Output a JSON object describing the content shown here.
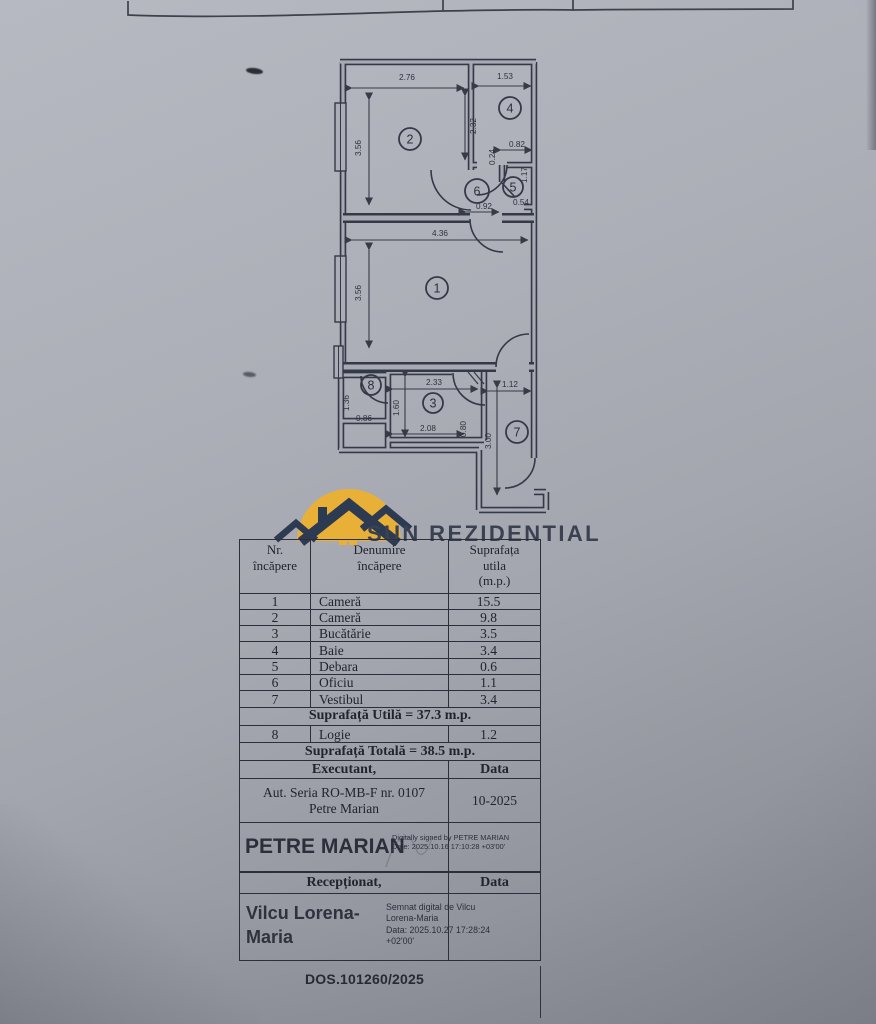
{
  "logo": {
    "title": "SUN REZIDENTIAL",
    "sun_color": "#e9b038",
    "house_color": "#2c3a52"
  },
  "floorplan": {
    "dims": [
      {
        "t": "2.76",
        "x": 407,
        "y": 80,
        "r": 0
      },
      {
        "t": "1.53",
        "x": 505,
        "y": 79,
        "r": 0
      },
      {
        "t": "3.56",
        "x": 361,
        "y": 148,
        "r": -90
      },
      {
        "t": "2.32",
        "x": 476,
        "y": 126,
        "r": -90
      },
      {
        "t": "0.82",
        "x": 517,
        "y": 147,
        "r": 0
      },
      {
        "t": "0.24",
        "x": 495,
        "y": 157,
        "r": -90
      },
      {
        "t": "1.17",
        "x": 527,
        "y": 175,
        "r": -90
      },
      {
        "t": "0.54",
        "x": 521,
        "y": 205,
        "r": 0
      },
      {
        "t": "0.92",
        "x": 484,
        "y": 209,
        "r": 0
      },
      {
        "t": "4.36",
        "x": 440,
        "y": 236,
        "r": 0
      },
      {
        "t": "3.56",
        "x": 361,
        "y": 293,
        "r": -90
      },
      {
        "t": "2.33",
        "x": 434,
        "y": 385,
        "r": 0
      },
      {
        "t": "1.12",
        "x": 510,
        "y": 387,
        "r": 0
      },
      {
        "t": "1.36",
        "x": 349,
        "y": 403,
        "r": -90
      },
      {
        "t": "1.60",
        "x": 399,
        "y": 408,
        "r": -90
      },
      {
        "t": "0.86",
        "x": 364,
        "y": 421,
        "r": 0
      },
      {
        "t": "2.08",
        "x": 428,
        "y": 431,
        "r": 0
      },
      {
        "t": "0.80",
        "x": 466,
        "y": 429,
        "r": -90
      },
      {
        "t": "3.00",
        "x": 491,
        "y": 441,
        "r": -90
      }
    ],
    "rooms": [
      {
        "n": "1",
        "x": 437,
        "y": 288,
        "r": 11
      },
      {
        "n": "2",
        "x": 410,
        "y": 139,
        "r": 11
      },
      {
        "n": "3",
        "x": 433,
        "y": 403,
        "r": 10
      },
      {
        "n": "4",
        "x": 510,
        "y": 108,
        "r": 11
      },
      {
        "n": "5",
        "x": 513,
        "y": 187,
        "r": 10
      },
      {
        "n": "6",
        "x": 477,
        "y": 191,
        "r": 12
      },
      {
        "n": "7",
        "x": 517,
        "y": 432,
        "r": 11
      },
      {
        "n": "8",
        "x": 371,
        "y": 385,
        "r": 10
      }
    ]
  },
  "table": {
    "headers": {
      "col1": "Nr.\nîncăpere",
      "col2": "Denumire\nîncăpere",
      "col3": "Suprafața\nutila\n(m.p.)"
    },
    "rooms": [
      {
        "nr": "1",
        "name": "Cameră",
        "area": "15.5"
      },
      {
        "nr": "2",
        "name": "Cameră",
        "area": "9.8"
      },
      {
        "nr": "3",
        "name": "Bucătărie",
        "area": "3.5"
      },
      {
        "nr": "4",
        "name": "Baie",
        "area": "3.4"
      },
      {
        "nr": "5",
        "name": "Debara",
        "area": "0.6"
      },
      {
        "nr": "6",
        "name": "Oficiu",
        "area": "1.1"
      },
      {
        "nr": "7",
        "name": "Vestibul",
        "area": "3.4"
      }
    ],
    "useful_total": "Suprafață Utilă = 37.3 m.p.",
    "logie": {
      "nr": "8",
      "name": "Logie",
      "area": "1.2"
    },
    "grand_total": "Suprafață Totală = 38.5 m.p.",
    "executant": {
      "label": "Executant,",
      "data_label": "Data"
    },
    "authorization": {
      "lines": "Aut. Seria RO-MB-F nr. 0107\nPetre Marian",
      "date": "10-2025"
    },
    "signature1": {
      "name": "PETRE MARIAN",
      "note": "Digitally signed by PETRE MARIAN\nDate: 2025.10.16 17:10:28 +03'00'"
    },
    "receptionat": {
      "label": "Recepționat,",
      "data_label": "Data"
    },
    "signature2": {
      "name": "Vilcu Lorena-\nMaria",
      "note": "Semnat digital de Vilcu\nLorena-Maria\nData: 2025.10.27 17:28:24\n+02'00'"
    },
    "dossier": "DOS.101260/2025"
  }
}
